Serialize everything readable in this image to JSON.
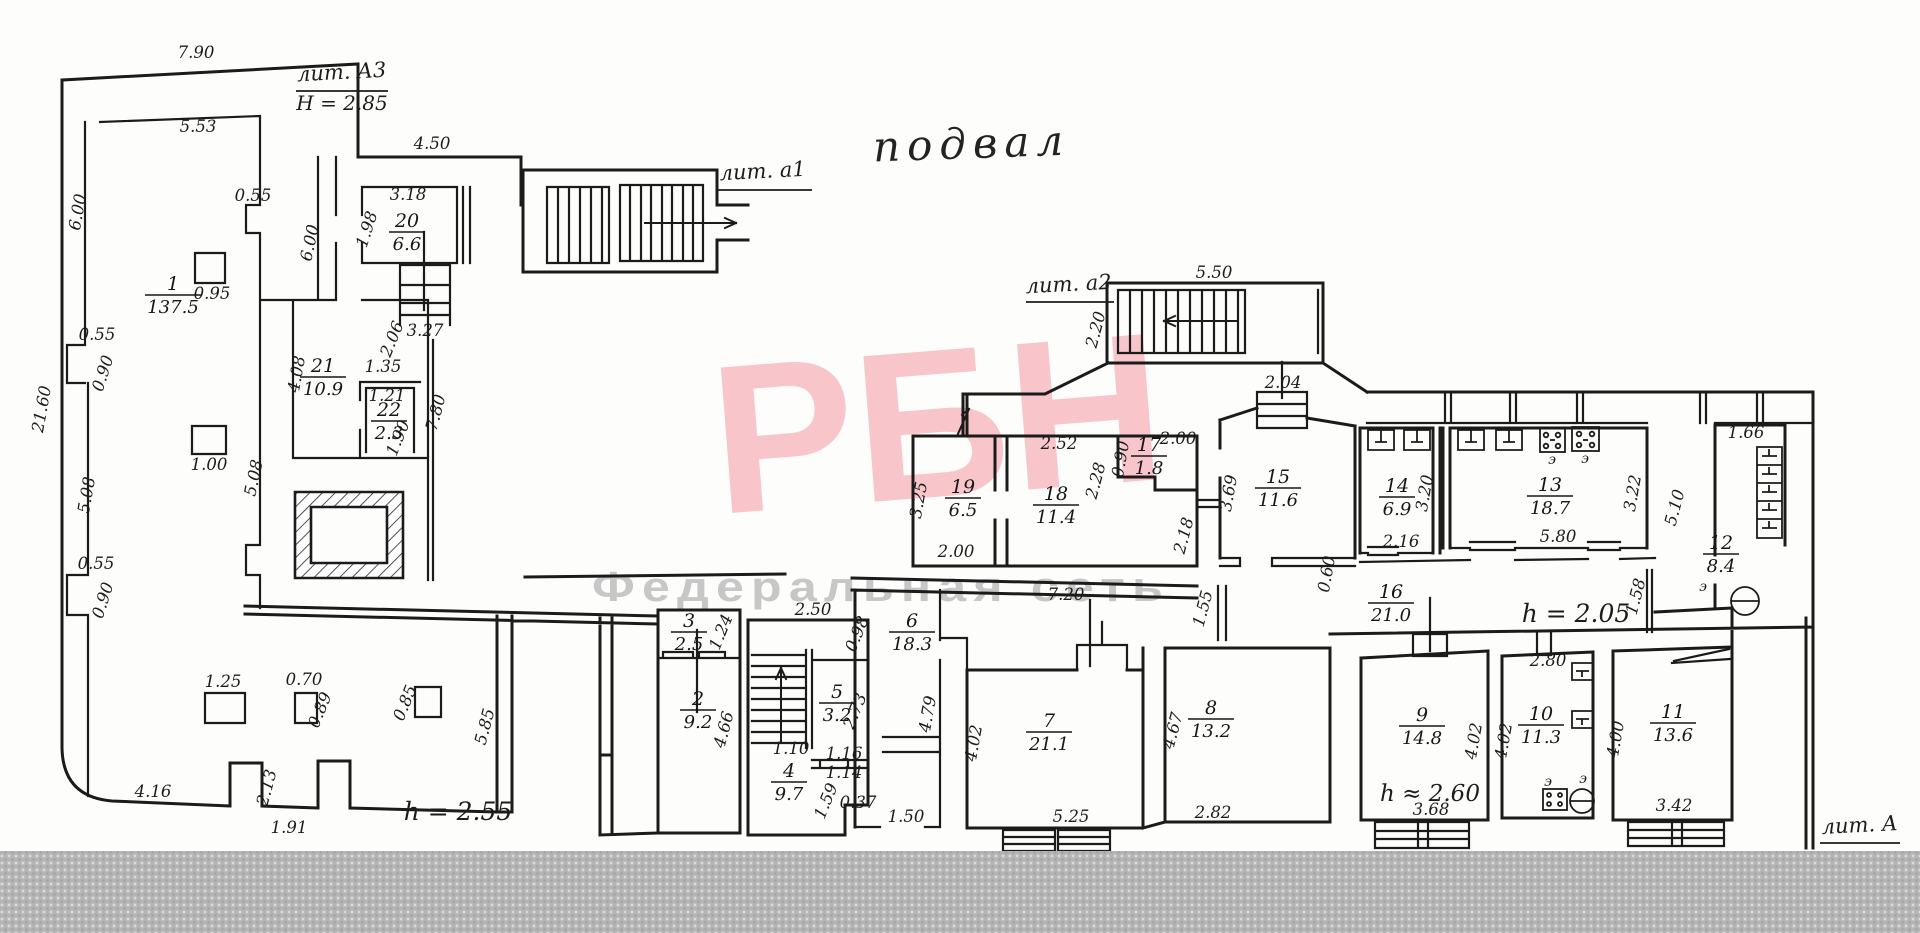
{
  "plan": {
    "title": "подвал",
    "litera": [
      {
        "label": "лит. А3",
        "x": 342,
        "y": 79,
        "ux1": 296,
        "ux2": 388,
        "uy": 91,
        "sub": "Н = 2.85",
        "sx": 342,
        "sy": 110
      },
      {
        "label": "лит. а1",
        "x": 763,
        "y": 178,
        "ux1": 716,
        "ux2": 812,
        "uy": 190,
        "sub": "",
        "sx": 0,
        "sy": 0
      },
      {
        "label": "лит. а2",
        "x": 1069,
        "y": 291,
        "ux1": 1026,
        "ux2": 1114,
        "uy": 302,
        "sub": "",
        "sx": 0,
        "sy": 0
      },
      {
        "label": "лит. А",
        "x": 1860,
        "y": 832,
        "ux1": 1820,
        "ux2": 1900,
        "uy": 843,
        "sub": "",
        "sx": 0,
        "sy": 0
      }
    ],
    "rooms": [
      {
        "num": "1",
        "area": "137.5",
        "x": 173,
        "y": 290
      },
      {
        "num": "2",
        "area": "9.2",
        "x": 698,
        "y": 705
      },
      {
        "num": "3",
        "area": "2.5",
        "x": 689,
        "y": 627
      },
      {
        "num": "4",
        "area": "9.7",
        "x": 789,
        "y": 777
      },
      {
        "num": "5",
        "area": "3.2",
        "x": 837,
        "y": 698
      },
      {
        "num": "6",
        "area": "18.3",
        "x": 912,
        "y": 627
      },
      {
        "num": "7",
        "area": "21.1",
        "x": 1049,
        "y": 727
      },
      {
        "num": "8",
        "area": "13.2",
        "x": 1211,
        "y": 714
      },
      {
        "num": "9",
        "area": "14.8",
        "x": 1422,
        "y": 721
      },
      {
        "num": "10",
        "area": "11.3",
        "x": 1541,
        "y": 720
      },
      {
        "num": "11",
        "area": "13.6",
        "x": 1673,
        "y": 718
      },
      {
        "num": "12",
        "area": "8.4",
        "x": 1721,
        "y": 549
      },
      {
        "num": "13",
        "area": "18.7",
        "x": 1550,
        "y": 491
      },
      {
        "num": "14",
        "area": "6.9",
        "x": 1397,
        "y": 492
      },
      {
        "num": "15",
        "area": "11.6",
        "x": 1278,
        "y": 483
      },
      {
        "num": "16",
        "area": "21.0",
        "x": 1391,
        "y": 598
      },
      {
        "num": "17",
        "area": "1.8",
        "x": 1149,
        "y": 451
      },
      {
        "num": "18",
        "area": "11.4",
        "x": 1056,
        "y": 500
      },
      {
        "num": "19",
        "area": "6.5",
        "x": 963,
        "y": 493
      },
      {
        "num": "20",
        "area": "6.6",
        "x": 407,
        "y": 227
      },
      {
        "num": "21",
        "area": "10.9",
        "x": 323,
        "y": 372
      },
      {
        "num": "22",
        "area": "2.3",
        "x": 389,
        "y": 416
      }
    ],
    "dimensions": [
      {
        "t": "7.90",
        "x": 196,
        "y": 58,
        "r": 0
      },
      {
        "t": "5.53",
        "x": 198,
        "y": 132,
        "r": 0
      },
      {
        "t": "4.50",
        "x": 432,
        "y": 149,
        "r": 0
      },
      {
        "t": "3.18",
        "x": 408,
        "y": 200,
        "r": 0
      },
      {
        "t": "1.98",
        "x": 372,
        "y": 231,
        "r": -72
      },
      {
        "t": "6.00",
        "x": 315,
        "y": 244,
        "r": -78
      },
      {
        "t": "3.27",
        "x": 425,
        "y": 336,
        "r": 0
      },
      {
        "t": "6.00",
        "x": 83,
        "y": 213,
        "r": -80
      },
      {
        "t": "0.55",
        "x": 97,
        "y": 340,
        "r": 0
      },
      {
        "t": "0.90",
        "x": 108,
        "y": 375,
        "r": -72
      },
      {
        "t": "21.60",
        "x": 47,
        "y": 410,
        "r": -80
      },
      {
        "t": "5.08",
        "x": 92,
        "y": 496,
        "r": -80
      },
      {
        "t": "5.08",
        "x": 259,
        "y": 479,
        "r": -78
      },
      {
        "t": "0.55",
        "x": 96,
        "y": 569,
        "r": 0
      },
      {
        "t": "0.90",
        "x": 108,
        "y": 602,
        "r": -72
      },
      {
        "t": "4.16",
        "x": 153,
        "y": 797,
        "r": 0
      },
      {
        "t": "2.13",
        "x": 272,
        "y": 789,
        "r": -75
      },
      {
        "t": "1.91",
        "x": 289,
        "y": 833,
        "r": 0
      },
      {
        "t": "1.25",
        "x": 223,
        "y": 687,
        "r": 0
      },
      {
        "t": "0.70",
        "x": 304,
        "y": 685,
        "r": 0
      },
      {
        "t": "0.89",
        "x": 325,
        "y": 712,
        "r": -68
      },
      {
        "t": "0.85",
        "x": 410,
        "y": 705,
        "r": -68
      },
      {
        "t": "0.95",
        "x": 212,
        "y": 299,
        "r": 0
      },
      {
        "t": "1.00",
        "x": 209,
        "y": 470,
        "r": 0
      },
      {
        "t": "0.55",
        "x": 253,
        "y": 201,
        "r": 0
      },
      {
        "t": "4.08",
        "x": 302,
        "y": 375,
        "r": -80
      },
      {
        "t": "2.06",
        "x": 397,
        "y": 341,
        "r": -68
      },
      {
        "t": "1.35",
        "x": 383,
        "y": 372,
        "r": 0
      },
      {
        "t": "1.21",
        "x": 387,
        "y": 401,
        "r": 0
      },
      {
        "t": "1.90",
        "x": 403,
        "y": 440,
        "r": -68
      },
      {
        "t": "7.80",
        "x": 441,
        "y": 414,
        "r": -75
      },
      {
        "t": "h = 2.55",
        "x": 458,
        "y": 820,
        "r": 0,
        "s": 25
      },
      {
        "t": "5.85",
        "x": 490,
        "y": 728,
        "r": -75
      },
      {
        "t": "1.24",
        "x": 726,
        "y": 634,
        "r": -68
      },
      {
        "t": "4.66",
        "x": 729,
        "y": 731,
        "r": -75
      },
      {
        "t": "2.50",
        "x": 813,
        "y": 615,
        "r": 0
      },
      {
        "t": "0.98",
        "x": 862,
        "y": 636,
        "r": -68
      },
      {
        "t": "1.10",
        "x": 791,
        "y": 754,
        "r": 0
      },
      {
        "t": "1.16",
        "x": 844,
        "y": 759,
        "r": 0
      },
      {
        "t": "1.14",
        "x": 844,
        "y": 778,
        "r": 0
      },
      {
        "t": "2.73",
        "x": 860,
        "y": 713,
        "r": -68
      },
      {
        "t": "1.59",
        "x": 831,
        "y": 803,
        "r": -68
      },
      {
        "t": "0.37",
        "x": 858,
        "y": 808,
        "r": 0
      },
      {
        "t": "4.79",
        "x": 933,
        "y": 715,
        "r": -80
      },
      {
        "t": "1.50",
        "x": 906,
        "y": 822,
        "r": 0
      },
      {
        "t": "7.20",
        "x": 1066,
        "y": 600,
        "r": 0
      },
      {
        "t": "2.00",
        "x": 956,
        "y": 557,
        "r": 0
      },
      {
        "t": "3.25",
        "x": 924,
        "y": 501,
        "r": -80
      },
      {
        "t": "2.52",
        "x": 1059,
        "y": 449,
        "r": 0
      },
      {
        "t": "0.90",
        "x": 1126,
        "y": 460,
        "r": -80
      },
      {
        "t": "2.00",
        "x": 1178,
        "y": 444,
        "r": 0
      },
      {
        "t": "2.28",
        "x": 1101,
        "y": 482,
        "r": -75
      },
      {
        "t": "2.18",
        "x": 1189,
        "y": 537,
        "r": -75
      },
      {
        "t": "3.69",
        "x": 1234,
        "y": 494,
        "r": -80
      },
      {
        "t": "0.60",
        "x": 1332,
        "y": 575,
        "r": -80
      },
      {
        "t": "1.55",
        "x": 1208,
        "y": 610,
        "r": -75
      },
      {
        "t": "2.04",
        "x": 1283,
        "y": 388,
        "r": 0
      },
      {
        "t": "5.50",
        "x": 1214,
        "y": 278,
        "r": 0
      },
      {
        "t": "2.20",
        "x": 1101,
        "y": 331,
        "r": -75
      },
      {
        "t": "2.16",
        "x": 1401,
        "y": 547,
        "r": 0
      },
      {
        "t": "3.20",
        "x": 1430,
        "y": 494,
        "r": -80
      },
      {
        "t": "5.80",
        "x": 1558,
        "y": 542,
        "r": 0
      },
      {
        "t": "3.22",
        "x": 1638,
        "y": 494,
        "r": -80
      },
      {
        "t": "5.10",
        "x": 1680,
        "y": 509,
        "r": -75
      },
      {
        "t": "1.66",
        "x": 1746,
        "y": 438,
        "r": 0
      },
      {
        "t": "1.58",
        "x": 1641,
        "y": 598,
        "r": -75
      },
      {
        "t": "h = 2.05",
        "x": 1576,
        "y": 622,
        "r": 0,
        "s": 25
      },
      {
        "t": "4.02",
        "x": 979,
        "y": 744,
        "r": -80
      },
      {
        "t": "5.25",
        "x": 1071,
        "y": 822,
        "r": 0
      },
      {
        "t": "4.67",
        "x": 1178,
        "y": 732,
        "r": -75
      },
      {
        "t": "2.82",
        "x": 1213,
        "y": 818,
        "r": 0
      },
      {
        "t": "4.02",
        "x": 1479,
        "y": 742,
        "r": -80
      },
      {
        "t": "3.68",
        "x": 1431,
        "y": 815,
        "r": 0
      },
      {
        "t": "h ≈ 2.60",
        "x": 1430,
        "y": 801,
        "r": 0,
        "s": 23
      },
      {
        "t": "2.80",
        "x": 1548,
        "y": 666,
        "r": 0
      },
      {
        "t": "4.02",
        "x": 1509,
        "y": 742,
        "r": -80
      },
      {
        "t": "4.00",
        "x": 1621,
        "y": 740,
        "r": -80
      },
      {
        "t": "3.42",
        "x": 1674,
        "y": 811,
        "r": 0
      }
    ],
    "equipment": [
      {
        "t": "э",
        "x": 1552,
        "y": 464
      },
      {
        "t": "э",
        "x": 1585,
        "y": 463
      },
      {
        "t": "э",
        "x": 1548,
        "y": 786
      },
      {
        "t": "э",
        "x": 1583,
        "y": 783
      },
      {
        "t": "э",
        "x": 1703,
        "y": 591
      }
    ]
  },
  "watermark": {
    "logo": "РБН",
    "subtitle": "Федеральная сеть",
    "logo_color": "#f8c5cb",
    "subtitle_color": "#c7c7c7"
  }
}
